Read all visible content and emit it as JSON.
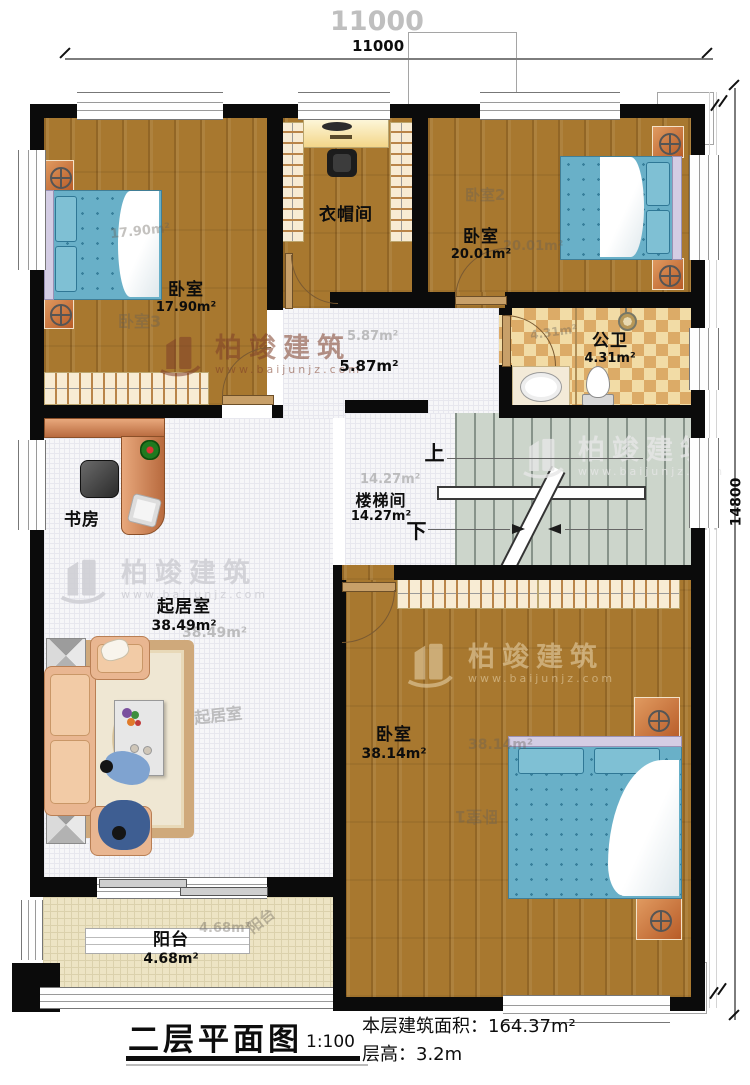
{
  "dimensions": {
    "top_total": "11000",
    "right_total": "14800"
  },
  "watermark": {
    "brand": "柏竣建筑",
    "url": "www.baijunjz.com"
  },
  "rooms": {
    "bedroom3": {
      "name": "卧室",
      "area": "17.90m²",
      "tag": "卧室3"
    },
    "cloakroom": {
      "name": "衣帽间"
    },
    "bedroom2": {
      "name": "卧室",
      "area": "20.01m²",
      "tag": "卧室2"
    },
    "bathroom": {
      "name": "公卫",
      "area": "4.31m²"
    },
    "hallway": {
      "area": "5.87m²"
    },
    "stairwell": {
      "name": "楼梯间",
      "area": "14.27m²",
      "up": "上",
      "down": "下"
    },
    "study": {
      "name": "书房"
    },
    "living": {
      "name": "起居室",
      "area": "38.49m²"
    },
    "bedroom1": {
      "name": "卧室",
      "area": "38.14m²",
      "tag": "卧室1"
    },
    "balcony": {
      "name": "阳台",
      "area": "4.68m²"
    }
  },
  "title": {
    "name": "二层平面图",
    "scale": "1:100",
    "floor_area": "本层建筑面积：164.37m²",
    "floor_height": "层高：3.2m"
  },
  "colors": {
    "wall": "#0b0b0b",
    "wood": "#a8782f",
    "tile": "#e9c583",
    "stair": "#ccd5cb",
    "bed": "#69b0c8",
    "balcony": "#ede4c4"
  }
}
